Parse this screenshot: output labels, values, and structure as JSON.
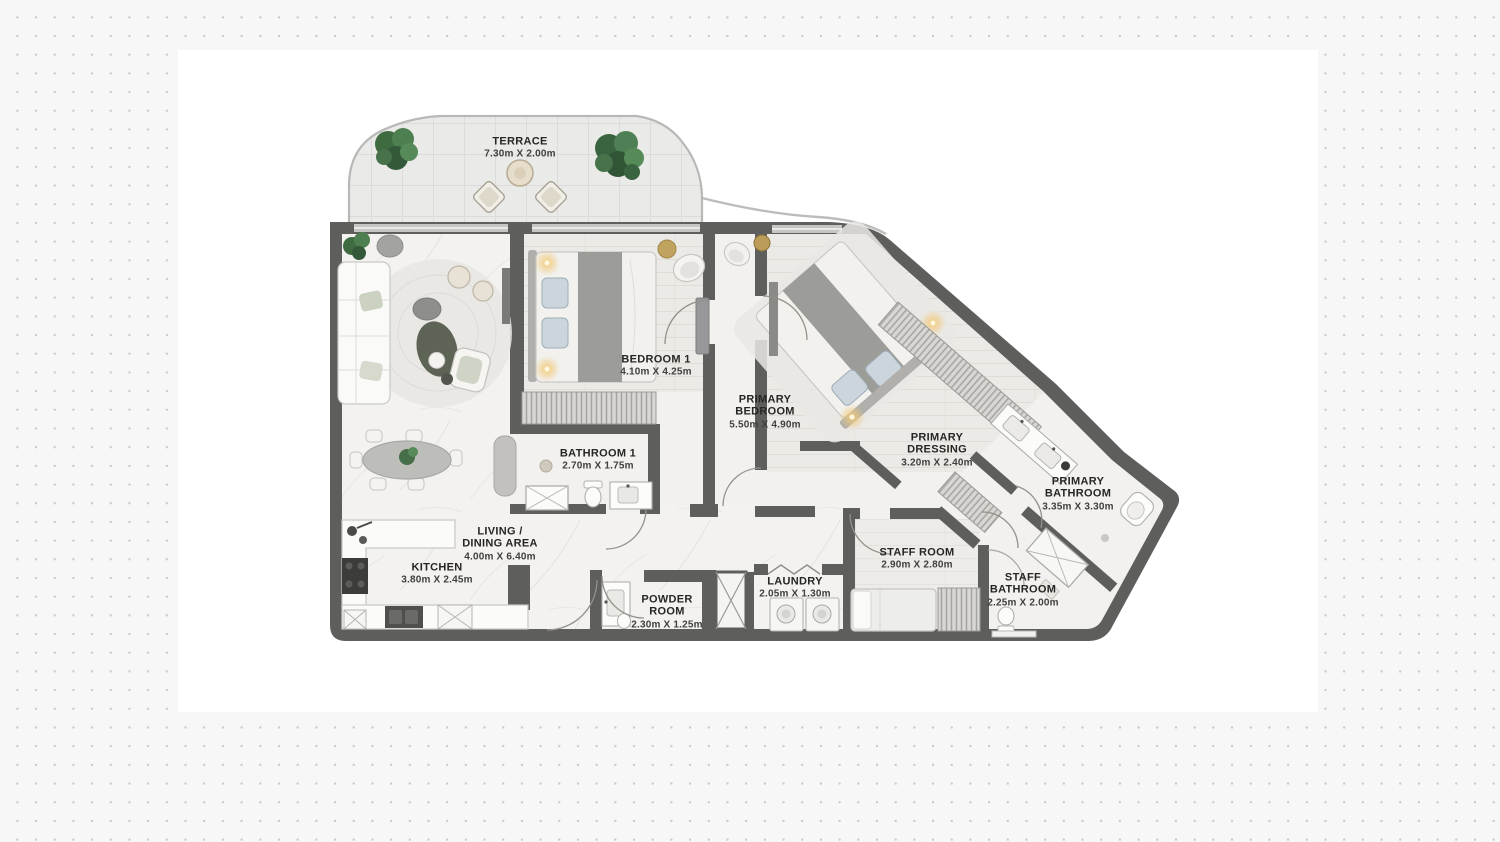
{
  "colors": {
    "wall": "#5e5e5c",
    "floor": "#f2f1ef",
    "wood_floor": "#eceae6",
    "terrace_floor": "#eaeae8",
    "plant_green": "#466e49",
    "ceiling_light_glow": "#f0c878",
    "label_text": "#262624",
    "background_dots": "#c9c9c9",
    "panel_background": "#ffffff"
  },
  "rooms": [
    {
      "id": "terrace",
      "name": "TERRACE",
      "dims": "7.30m X 2.00m"
    },
    {
      "id": "bedroom-1",
      "name": "BEDROOM 1",
      "dims": "4.10m X 4.25m"
    },
    {
      "id": "primary-bedroom",
      "name": "PRIMARY\nBEDROOM",
      "dims": "5.50m X 4.90m"
    },
    {
      "id": "primary-dressing",
      "name": "PRIMARY\nDRESSING",
      "dims": "3.20m X 2.40m"
    },
    {
      "id": "primary-bathroom",
      "name": "PRIMARY\nBATHROOM",
      "dims": "3.35m X 3.30m"
    },
    {
      "id": "bathroom-1",
      "name": "BATHROOM 1",
      "dims": "2.70m X 1.75m"
    },
    {
      "id": "living-dining",
      "name": "LIVING /\nDINING AREA",
      "dims": "4.00m X 6.40m"
    },
    {
      "id": "kitchen",
      "name": "KITCHEN",
      "dims": "3.80m X 2.45m"
    },
    {
      "id": "powder-room",
      "name": "POWDER\nROOM",
      "dims": "2.30m X 1.25m"
    },
    {
      "id": "laundry",
      "name": "LAUNDRY",
      "dims": "2.05m X 1.30m"
    },
    {
      "id": "staff-room",
      "name": "STAFF ROOM",
      "dims": "2.90m X 2.80m"
    },
    {
      "id": "staff-bathroom",
      "name": "STAFF\nBATHROOM",
      "dims": "2.25m X 2.00m"
    }
  ]
}
